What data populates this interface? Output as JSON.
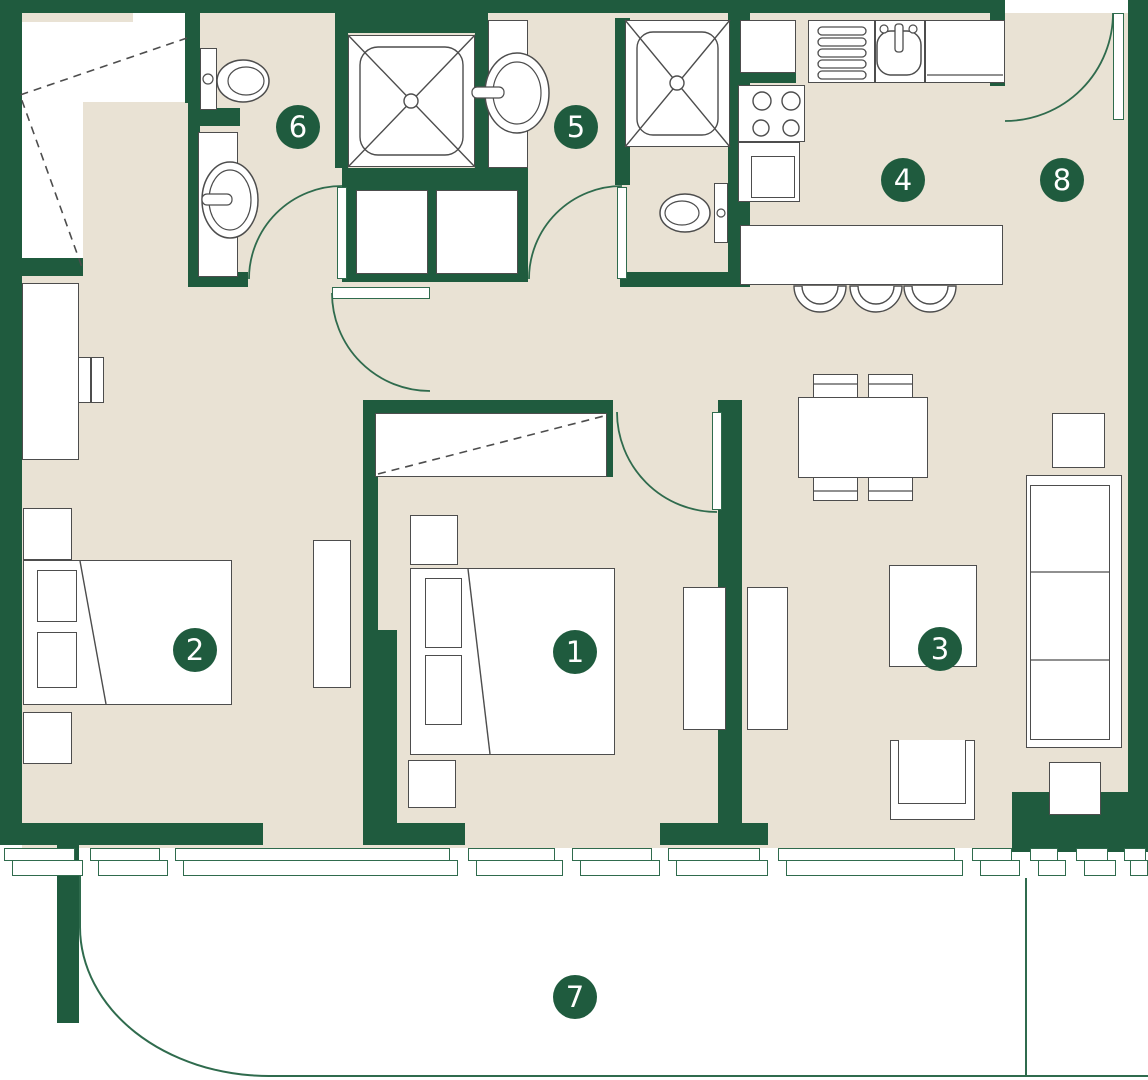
{
  "title": "apartment-floor-plan",
  "badges": [
    {
      "number": "1"
    },
    {
      "number": "2"
    },
    {
      "number": "3"
    },
    {
      "number": "4"
    },
    {
      "number": "5"
    },
    {
      "number": "6"
    },
    {
      "number": "7"
    },
    {
      "number": "8"
    }
  ],
  "colors": {
    "wall": "#1F5B3E",
    "floor": "#E9E2D4",
    "line": "#2F6B4D",
    "outline": "#4D4D4D",
    "badge": "#1F5B3E",
    "badge_text": "#FFFFFF",
    "bg": "#FFFFFF"
  }
}
